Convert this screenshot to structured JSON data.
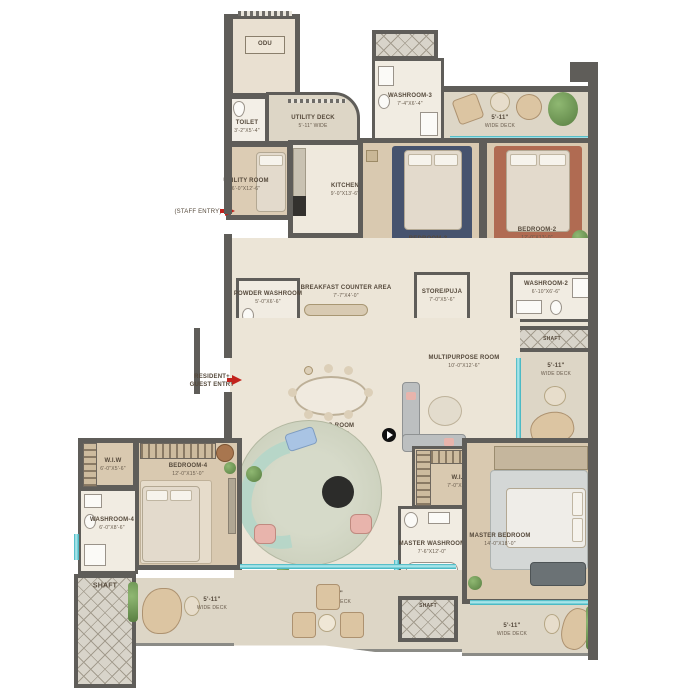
{
  "colors": {
    "wall": "#5f5d59",
    "floor": "#ece5d7",
    "wood_floor": "#d9c9b0",
    "deck": "#ddd6c6",
    "glass": "#7fd3da",
    "entry_arrow": "#c2231d",
    "rug_bedroom3": "#46536e",
    "rug_bedroom2": "#b06b52",
    "living_rug": "#ccd1bf",
    "sofa_curve": "#b7d6c8"
  },
  "rooms": {
    "odu": {
      "name": "ODU",
      "dims": ""
    },
    "toilet": {
      "name": "TOILET",
      "dims": "3'-2\"X5'-4\""
    },
    "utility_deck": {
      "name": "UTILITY DECK",
      "dims": "5'-11\" WIDE"
    },
    "utility_room": {
      "name": "UTILITY ROOM",
      "dims": "6'-0\"X12'-6\""
    },
    "kitchen": {
      "name": "KITCHEN",
      "dims": "9'-0\"X13'-6\""
    },
    "washroom3": {
      "name": "WASHROOM-3",
      "dims": "7'-4\"X6'-4\""
    },
    "bedroom3": {
      "name": "BEDROOM-3",
      "dims": "11'-6\"X13'-0\""
    },
    "bedroom2": {
      "name": "BEDROOM-2",
      "dims": "12'-0\"X13'-0\""
    },
    "breakfast": {
      "name": "BREAKFAST COUNTER AREA",
      "dims": "7'-7\"X4'-0\""
    },
    "powder": {
      "name": "POWDER WASHROOM",
      "dims": "5'-0\"X6'-6\""
    },
    "store_puja": {
      "name": "STORE/PUJA",
      "dims": "7'-0\"X5'-6\""
    },
    "washroom2": {
      "name": "WASHROOM-2",
      "dims": "6'-10\"X6'-6\""
    },
    "multipurpose": {
      "name": "MULTIPURPOSE ROOM",
      "dims": "10'-0\"X12'-6\""
    },
    "living": {
      "name": "LIVING ROOM",
      "dims": "18'-0\"X26'-0\""
    },
    "wiw4": {
      "name": "W.I.W",
      "dims": "6'-0\"X5'-6\""
    },
    "bedroom4": {
      "name": "BEDROOM-4",
      "dims": "12'-0\"X15'-0\""
    },
    "washroom4": {
      "name": "WASHROOM-4",
      "dims": "6'-0\"X8'-6\""
    },
    "master_wiw": {
      "name": "W.I.W",
      "dims": "7'-0\"X6'-0\""
    },
    "master_washroom": {
      "name": "MASTER WASHROOM",
      "dims": "7'-6\"X12'-0\""
    },
    "master_bedroom": {
      "name": "MASTER BEDROOM",
      "dims": "14'-0\"X18'-0\""
    }
  },
  "decks": {
    "top_right": {
      "width": "5'-11\"",
      "label": "WIDE DECK"
    },
    "right": {
      "width": "5'-11\"",
      "label": "WIDE DECK"
    },
    "bottom_left": {
      "width": "5'-11\"",
      "label": "WIDE DECK"
    },
    "bottom_middle": {
      "width": "9'-0\"",
      "label": "WIDE DECK"
    },
    "bottom_right": {
      "width": "5'-11\"",
      "label": "WIDE DECK"
    }
  },
  "shafts": {
    "bottom_left": "SHAFT",
    "bottom_middle": "SHAFT",
    "mid_right": "SHAFT"
  },
  "entries": {
    "staff": "(STAFF ENTRY)",
    "resident_line1": "RESIDENT+",
    "resident_line2": "GUEST ENTRY",
    "service_line1": "SERVICE",
    "service_line2": "PERSONNEL",
    "service_line3": "ENTRY"
  }
}
